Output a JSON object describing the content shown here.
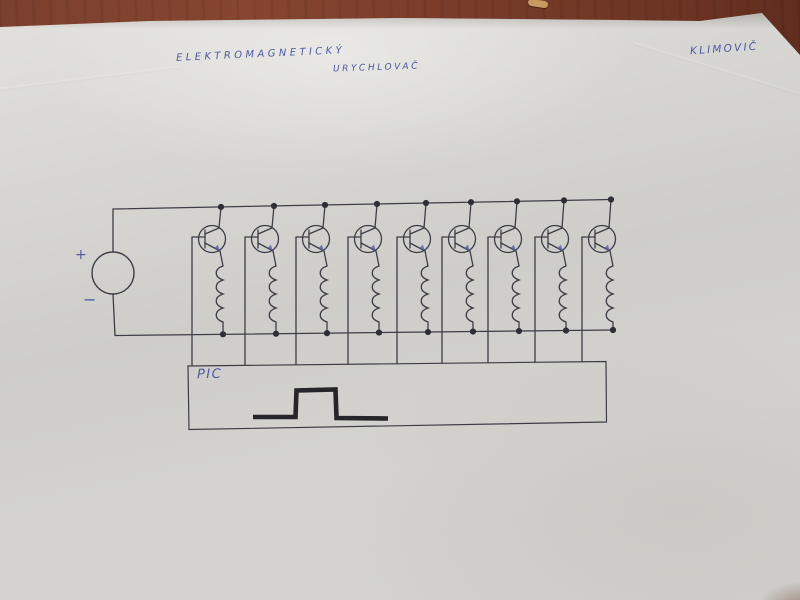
{
  "photo": {
    "scene": "hand-drawn schematic on white paper lying on a brown wooden table",
    "colors": {
      "table": "#7a3d2b",
      "paper": "#d6d5d1",
      "ink": "#3d3d47",
      "ink_dark": "#2e2e36",
      "pen_blue": "#4f58a4",
      "pulse_marker": "#26262a",
      "debris": "#c89a60"
    }
  },
  "diagram": {
    "title_line1": "ELEKTROMAGNETICKÝ",
    "title_line2": "URYCHLOVAČ",
    "author": "KLIMOVIČ",
    "source_positive": "+",
    "source_negative": "−",
    "controller_label": "PIC",
    "description": "DC source feeding 9 transistor-switched coil stages between two supply rails; each transistor base is driven by a PIC controller box that outputs a square pulse",
    "component_counts": {
      "transistors": 9,
      "coils": 9,
      "power_sources": 1,
      "controllers": 1
    },
    "geometry": {
      "stage_x": [
        221,
        274,
        325,
        377,
        426,
        471,
        517,
        564,
        611
      ],
      "top_rail": {
        "x1": 113,
        "y1": 209,
        "x2": 611,
        "y2": 199.5
      },
      "bottom_rail": {
        "x1": 115,
        "y1": 335.5,
        "x2": 613,
        "y2": 330
      },
      "transistor_cy": 239,
      "transistor_r": 13.5,
      "coil_top_y": 266,
      "coil_bumps": 4,
      "coil_bump_h": 14,
      "source": {
        "cx": 113,
        "cy": 273,
        "r": 21
      },
      "pic_box": [
        [
          188,
          366
        ],
        [
          606,
          361.5
        ],
        [
          606.5,
          422
        ],
        [
          189,
          429.5
        ]
      ],
      "pulse_points": [
        [
          253,
          417
        ],
        [
          295.5,
          417
        ],
        [
          296.5,
          390.5
        ],
        [
          335.5,
          389.5
        ],
        [
          336.5,
          418
        ],
        [
          388,
          418.5
        ]
      ]
    }
  }
}
